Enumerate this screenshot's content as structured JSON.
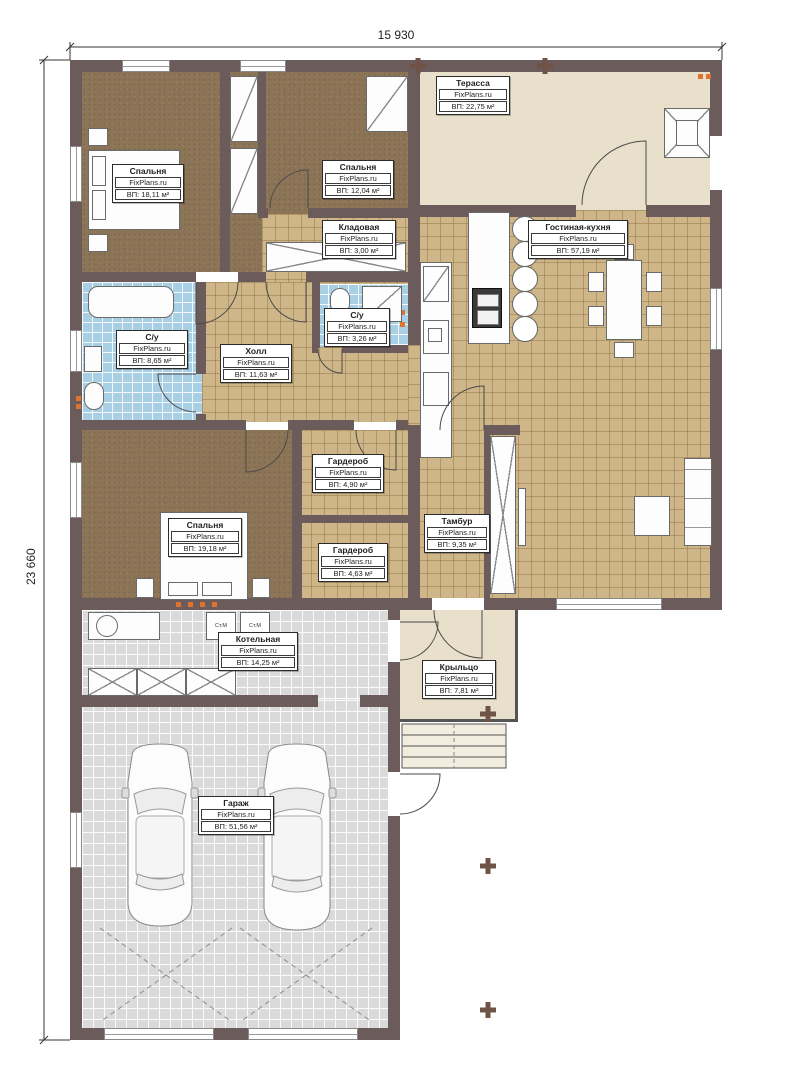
{
  "brand": "FixPlans.ru",
  "dimensions": {
    "top": "15 930",
    "left": "23 660"
  },
  "rooms": [
    {
      "id": "bedroom-1",
      "name": "Спальня",
      "area": "ВП: 18,11 м²"
    },
    {
      "id": "bedroom-2",
      "name": "Спальня",
      "area": "ВП: 12,04 м²"
    },
    {
      "id": "terrace",
      "name": "Терасса",
      "area": "ВП: 22,75 м²"
    },
    {
      "id": "storage",
      "name": "Кладовая",
      "area": "ВП: 3,00 м²"
    },
    {
      "id": "living-kitchen",
      "name": "Гостиная-кухня",
      "area": "ВП: 57,19 м²"
    },
    {
      "id": "bathroom-1",
      "name": "С/у",
      "area": "ВП: 8,65 м²"
    },
    {
      "id": "hall",
      "name": "Холл",
      "area": "ВП: 11,63 м²"
    },
    {
      "id": "bathroom-2",
      "name": "С/у",
      "area": "ВП: 3,26 м²"
    },
    {
      "id": "wardrobe-1",
      "name": "Гардероб",
      "area": "ВП: 4,90 м²"
    },
    {
      "id": "bedroom-3",
      "name": "Спальня",
      "area": "ВП: 19,18 м²"
    },
    {
      "id": "wardrobe-2",
      "name": "Гардероб",
      "area": "ВП: 4,63 м²"
    },
    {
      "id": "vestibule",
      "name": "Тамбур",
      "area": "ВП: 9,35 м²"
    },
    {
      "id": "boiler-room",
      "name": "Котельная",
      "area": "ВП: 14,25 м²"
    },
    {
      "id": "porch",
      "name": "Крыльцо",
      "area": "ВП: 7,81 м²"
    },
    {
      "id": "garage",
      "name": "Гараж",
      "area": "ВП: 51,56 м²"
    }
  ],
  "appliances": {
    "washer1": "Ст.М",
    "washer2": "Ст.М"
  },
  "colors": {
    "wall": "#6c5b5b",
    "floor_wood": "#8c7457",
    "floor_tile": "#cfb689",
    "floor_bath": "#a9cfe4",
    "floor_garage": "#dadada",
    "terrace": "#e9e0cb",
    "marker_orange": "#e0722f"
  }
}
